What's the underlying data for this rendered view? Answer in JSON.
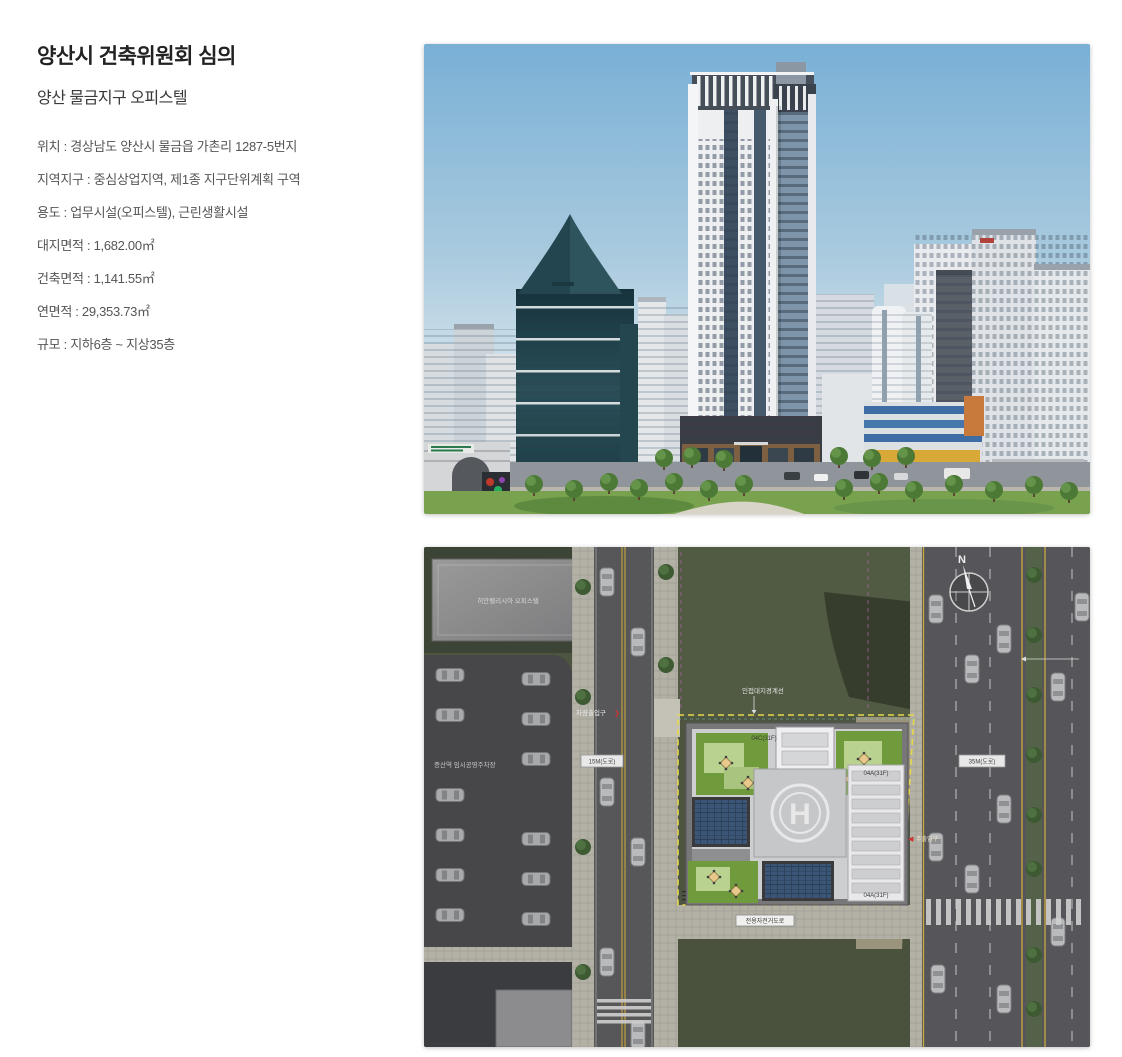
{
  "header": {
    "title": "양산시 건축위원회 심의",
    "subtitle": "양산 물금지구 오피스텔"
  },
  "details": {
    "lines": [
      "위치 : 경상남도 양산시 물금읍 가촌리 1287-5번지",
      "지역지구 : 중심상업지역, 제1종 지구단위계획 구역",
      "용도 : 업무시설(오피스텔), 근린생활시설",
      "대지면적 : 1,682.00㎡",
      "건축면적 : 1,141.55㎡",
      "연면적 : 29,353.73㎡",
      "규모 : 지하6층 ~ 지상35층"
    ]
  },
  "siteplan": {
    "north_label": "N",
    "helipad_letter": "H",
    "neighbor_building_label": "히안펠리시아 오피스텔",
    "parking_label": "증산역 임시공영주차장",
    "left_road_label": "15M(도로)",
    "right_road_label": "35M(도로)",
    "bike_path_label": "전용자전거도로",
    "boundary_label": "인접대지경계선",
    "vehicle_entrance_label": "차량출입구",
    "vehicle_entrance_arrow": "❯",
    "main_entrance_arrow": "◀",
    "main_entrance_label": "주출입구",
    "roof_labels": {
      "core": "04C(31F)",
      "east_upper": "04A(31F)",
      "east_lower": "04A(31F)"
    }
  },
  "colors": {
    "boundary_yellow": "#e6d84a",
    "setback_magenta": "#c06ac0",
    "lawn_green": "#4d5540",
    "roof_garden_green": "#6f9b3c",
    "solar_blue": "#3a5575",
    "sky_blue": "#79b0d6",
    "banner_red": "#a53532"
  }
}
